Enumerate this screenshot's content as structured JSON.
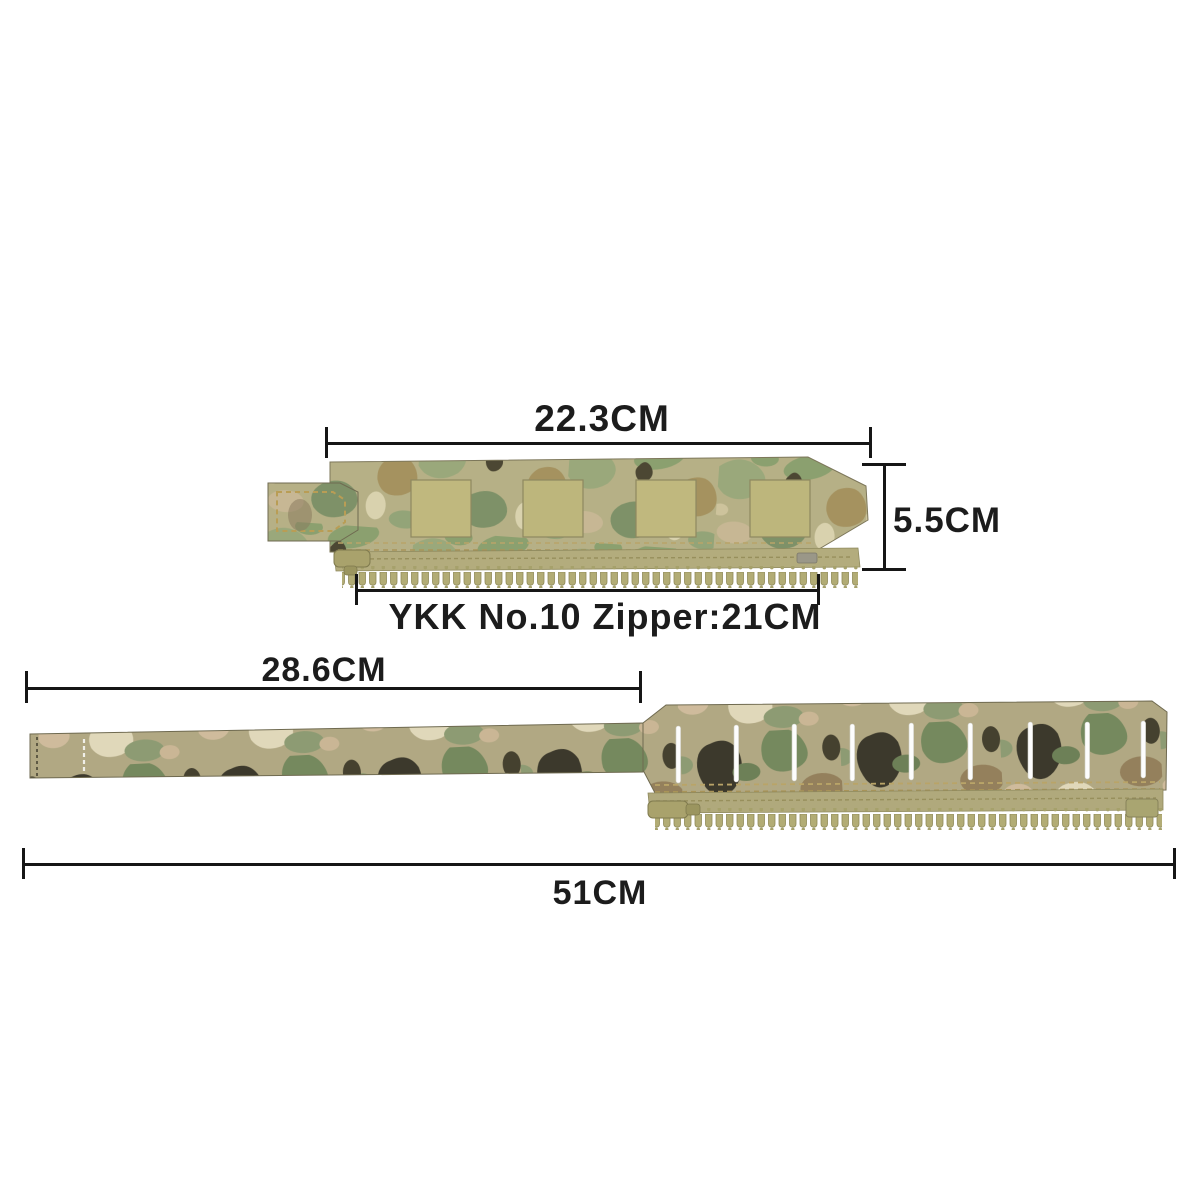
{
  "image_type": "camouflage zipper adapter strap dimension diagram",
  "annotations": {
    "top_width": "22.3CM",
    "panel_height": "5.5CM",
    "zipper_spec": "YKK No.10 Zipper:21CM",
    "strap_length": "28.6CM",
    "total_length": "51CM"
  },
  "palette": {
    "background": "#ffffff",
    "dimension_line": "#161616",
    "label_text": "#1c1c1c",
    "camo_base": "#b6b086",
    "camo_light_green": "#9aa87b",
    "camo_green": "#8ba06f",
    "camo_dark_green": "#75895e",
    "camo_brown": "#a5925f",
    "camo_cream": "#ddd5b2",
    "camo_pink_tan": "#cfbb9c",
    "camo_dark": "#3c392c",
    "zipper_teeth": "#b2ac75",
    "zipper_tape": "#b3ac7d",
    "webbing_square": "#c0b87e",
    "stitch_tan": "#b99d55",
    "laser_slit": "#fdfdfd"
  }
}
